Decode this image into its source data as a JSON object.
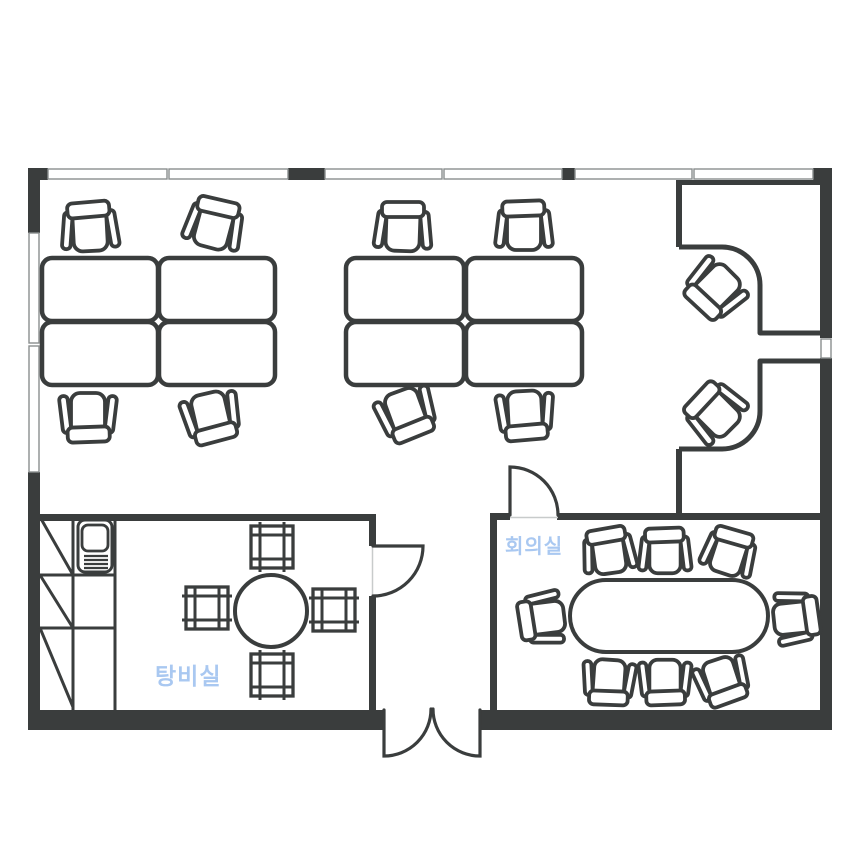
{
  "title": "Office floor plan",
  "colors": {
    "background": "#ffffff",
    "wall": "#3a3d3d",
    "furniture_stroke": "#3a3d3d",
    "window_stroke": "#8a8e8e",
    "threshold": "#c8cbcb",
    "room_label": "#a9c8f1"
  },
  "labels": {
    "meeting_room": {
      "text": "회의실",
      "x": 505,
      "y": 537,
      "font_size": 20
    },
    "pantry": {
      "text": "탕비실",
      "x": 155,
      "y": 665,
      "font_size": 23
    }
  },
  "plan": {
    "outer_wall_rects": [
      [
        28,
        168,
        20,
        12
      ],
      [
        288,
        168,
        37,
        12
      ],
      [
        562,
        168,
        13,
        12
      ],
      [
        813,
        168,
        19,
        12
      ],
      [
        28,
        168,
        12,
        65
      ],
      [
        28,
        472,
        12,
        258
      ],
      [
        820,
        168,
        12,
        170
      ],
      [
        820,
        358,
        12,
        372
      ],
      [
        28,
        710,
        356,
        20
      ],
      [
        480,
        710,
        352,
        20
      ]
    ],
    "inner_wall_rects": [
      [
        40,
        514,
        330,
        7
      ],
      [
        369,
        514,
        7,
        32
      ],
      [
        369,
        596,
        7,
        114
      ],
      [
        490,
        513,
        20,
        7
      ],
      [
        557,
        513,
        263,
        7
      ],
      [
        490,
        513,
        7,
        197
      ],
      [
        676,
        180,
        6,
        67
      ],
      [
        676,
        449,
        6,
        68
      ],
      [
        682,
        180,
        138,
        5
      ]
    ],
    "window_panes": [
      [
        48,
        169,
        119,
        10
      ],
      [
        169,
        169,
        119,
        10
      ],
      [
        325,
        169,
        117,
        10
      ],
      [
        444,
        169,
        118,
        10
      ],
      [
        575,
        169,
        117,
        10
      ],
      [
        694,
        169,
        119,
        10
      ],
      [
        29,
        233,
        10,
        110
      ],
      [
        29,
        346,
        10,
        126
      ],
      [
        821,
        339,
        10,
        19
      ]
    ],
    "counter_paths": [
      "M 679 247 H 722 A 38 38 0 0 1 760 285 V 333 H 820",
      "M 679 449 H 722 A 38 38 0 0 0 760 411 V 361 H 820"
    ],
    "door_paths": [
      "M 373 546 H 423 A 50 50 0 0 1 373 596",
      "M 510 515 V 467 A 48 48 0 0 1 558 515",
      "M 384 710 V 756 A 47 47 0 0 0 431 709",
      "M 480 710 V 756 A 47 47 0 0 1 433 709"
    ],
    "threshold_lines": [
      [
        372.5,
        546,
        372.5,
        596
      ],
      [
        510,
        517.5,
        558,
        517.5
      ]
    ],
    "desks": [
      [
        42,
        258,
        116,
        63
      ],
      [
        159,
        258,
        116,
        63
      ],
      [
        42,
        322,
        116,
        63
      ],
      [
        159,
        322,
        116,
        63
      ],
      [
        346,
        258,
        118,
        63
      ],
      [
        466,
        258,
        116,
        63
      ],
      [
        346,
        322,
        118,
        63
      ],
      [
        466,
        322,
        116,
        63
      ]
    ],
    "office_chairs": [
      {
        "x": 90,
        "y": 229,
        "r": -3
      },
      {
        "x": 214,
        "y": 226,
        "r": 15
      },
      {
        "x": 88,
        "y": 415,
        "r": 180
      },
      {
        "x": 211,
        "y": 415,
        "r": 167
      },
      {
        "x": 403,
        "y": 229,
        "r": 2
      },
      {
        "x": 524,
        "y": 228,
        "r": 0
      },
      {
        "x": 406,
        "y": 412,
        "r": 160
      },
      {
        "x": 525,
        "y": 413,
        "r": 177
      },
      {
        "x": 716,
        "y": 288,
        "r": -135
      },
      {
        "x": 716,
        "y": 413,
        "r": -45
      }
    ],
    "meeting_chairs": [
      {
        "x": 609,
        "y": 553,
        "r": -8
      },
      {
        "x": 665,
        "y": 553,
        "r": 0
      },
      {
        "x": 729,
        "y": 554,
        "r": 18
      },
      {
        "x": 609,
        "y": 680,
        "r": 184
      },
      {
        "x": 665,
        "y": 680,
        "r": 180
      },
      {
        "x": 722,
        "y": 679,
        "r": 162
      },
      {
        "x": 544,
        "y": 618,
        "r": -97
      },
      {
        "x": 794,
        "y": 618,
        "r": 84
      }
    ],
    "stools": [
      {
        "x": 272,
        "y": 547,
        "r": 0
      },
      {
        "x": 272,
        "y": 675,
        "r": 0
      },
      {
        "x": 207,
        "y": 608,
        "r": 90
      },
      {
        "x": 334,
        "y": 610,
        "r": 90
      }
    ],
    "meeting_table": {
      "x": 570,
      "y": 580,
      "w": 198,
      "h": 72,
      "rx": 36
    },
    "round_table": {
      "cx": 271,
      "cy": 611,
      "r": 36
    },
    "cabinet_lines": [
      [
        73,
        517,
        73,
        710
      ],
      [
        115,
        517,
        115,
        710
      ],
      [
        40,
        575,
        115,
        575
      ],
      [
        40,
        628,
        115,
        628
      ],
      [
        40,
        517,
        73,
        575
      ],
      [
        40,
        575,
        73,
        628
      ],
      [
        40,
        628,
        73,
        707
      ]
    ],
    "sink": {
      "outer": [
        78,
        520,
        34,
        52,
        7
      ],
      "basin": [
        82,
        525,
        26,
        26,
        6
      ],
      "drain_lines": [
        [
          84,
          556,
          108,
          556
        ],
        [
          84,
          560,
          108,
          560
        ],
        [
          84,
          564,
          108,
          564
        ],
        [
          84,
          568,
          108,
          568
        ]
      ]
    }
  }
}
